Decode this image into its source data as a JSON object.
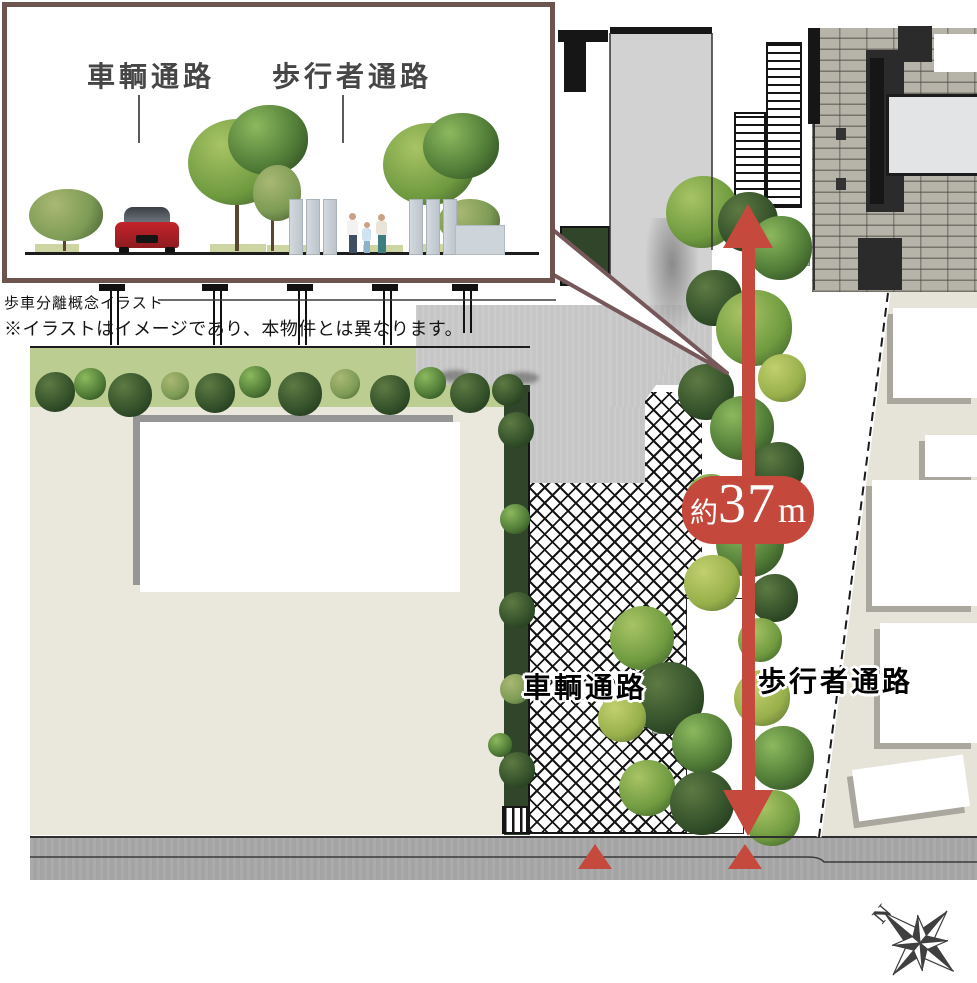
{
  "inset": {
    "vehicle_label": "車輌通路",
    "pedestrian_label": "歩行者通路",
    "caption": "歩車分離概念イラスト",
    "disclaimer": "※イラストはイメージであり、本物件とは異なります。",
    "border_color": "#6d544f"
  },
  "plan": {
    "vehicle_path_label": "車輌通路",
    "pedestrian_path_label": "歩行者通路",
    "distance_badge": {
      "prefix": "約",
      "value": "37",
      "unit": "m",
      "color": "#c4483c"
    },
    "compass": {
      "label": "N"
    },
    "accent_red": "#c6493d"
  }
}
